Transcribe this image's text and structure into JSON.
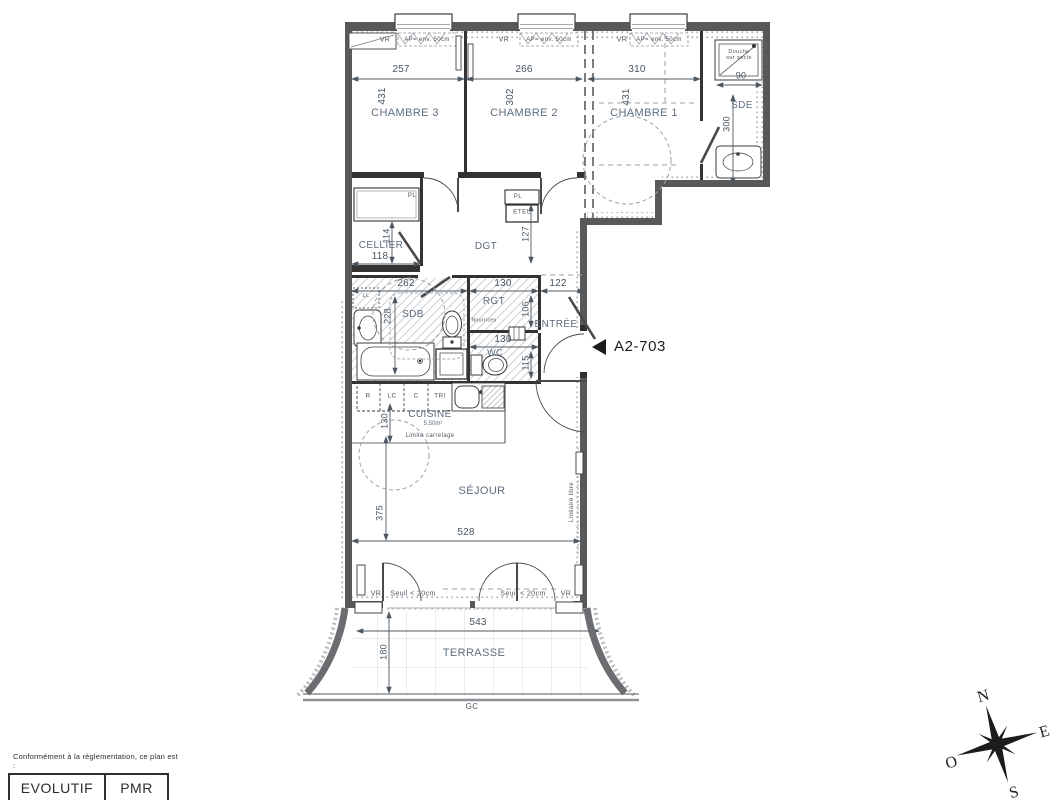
{
  "unit": {
    "code": "A2-703"
  },
  "rooms": {
    "chambre3": {
      "label": "CHAMBRE 3",
      "width": "257",
      "depth": "431"
    },
    "chambre2": {
      "label": "CHAMBRE 2",
      "width": "266",
      "depth": "302"
    },
    "chambre1": {
      "label": "CHAMBRE 1",
      "width": "310",
      "depth": "431"
    },
    "sde": {
      "label": "SDE",
      "depth": "300",
      "shower_note": "Douche sur socle",
      "shower_width": "90"
    },
    "cellier": {
      "label": "CELLIER",
      "width": "118",
      "depth": "114"
    },
    "dgt": {
      "label": "DGT",
      "depth": "127"
    },
    "sdb": {
      "label": "SDB",
      "width": "262",
      "depth": "228"
    },
    "rgt": {
      "label": "RGT",
      "width": "130",
      "depth": "106"
    },
    "entree": {
      "label": "ENTRÉE",
      "width": "122"
    },
    "wc": {
      "label": "WC",
      "width": "130",
      "depth": "115"
    },
    "cuisine": {
      "label": "CUISINE",
      "area": "5.50m²",
      "depth": "130"
    },
    "sejour": {
      "label": "SÉJOUR",
      "width": "528",
      "depth": "375"
    },
    "terrasse": {
      "label": "TERRASSE",
      "width": "543",
      "depth": "180"
    }
  },
  "ann": {
    "vr": "VR",
    "ap": "AP= env. 50cm",
    "pl": "PL",
    "etel": "ETEL",
    "ll": "LL",
    "nourrices": "Nourrices",
    "r": "R",
    "lc": "LC",
    "c": "C",
    "tri": "TRI",
    "limite": "Limite carrelage",
    "lineaire": "Linéaire libre",
    "seuil": "Seuil < 20cm",
    "gc": "GC"
  },
  "compass": {
    "north": "N",
    "east": "E",
    "south": "S",
    "west": "O"
  },
  "legend": {
    "title": "Conformément à la réglementation, ce plan est :",
    "items": [
      "EVOLUTIF",
      "PMR"
    ]
  }
}
